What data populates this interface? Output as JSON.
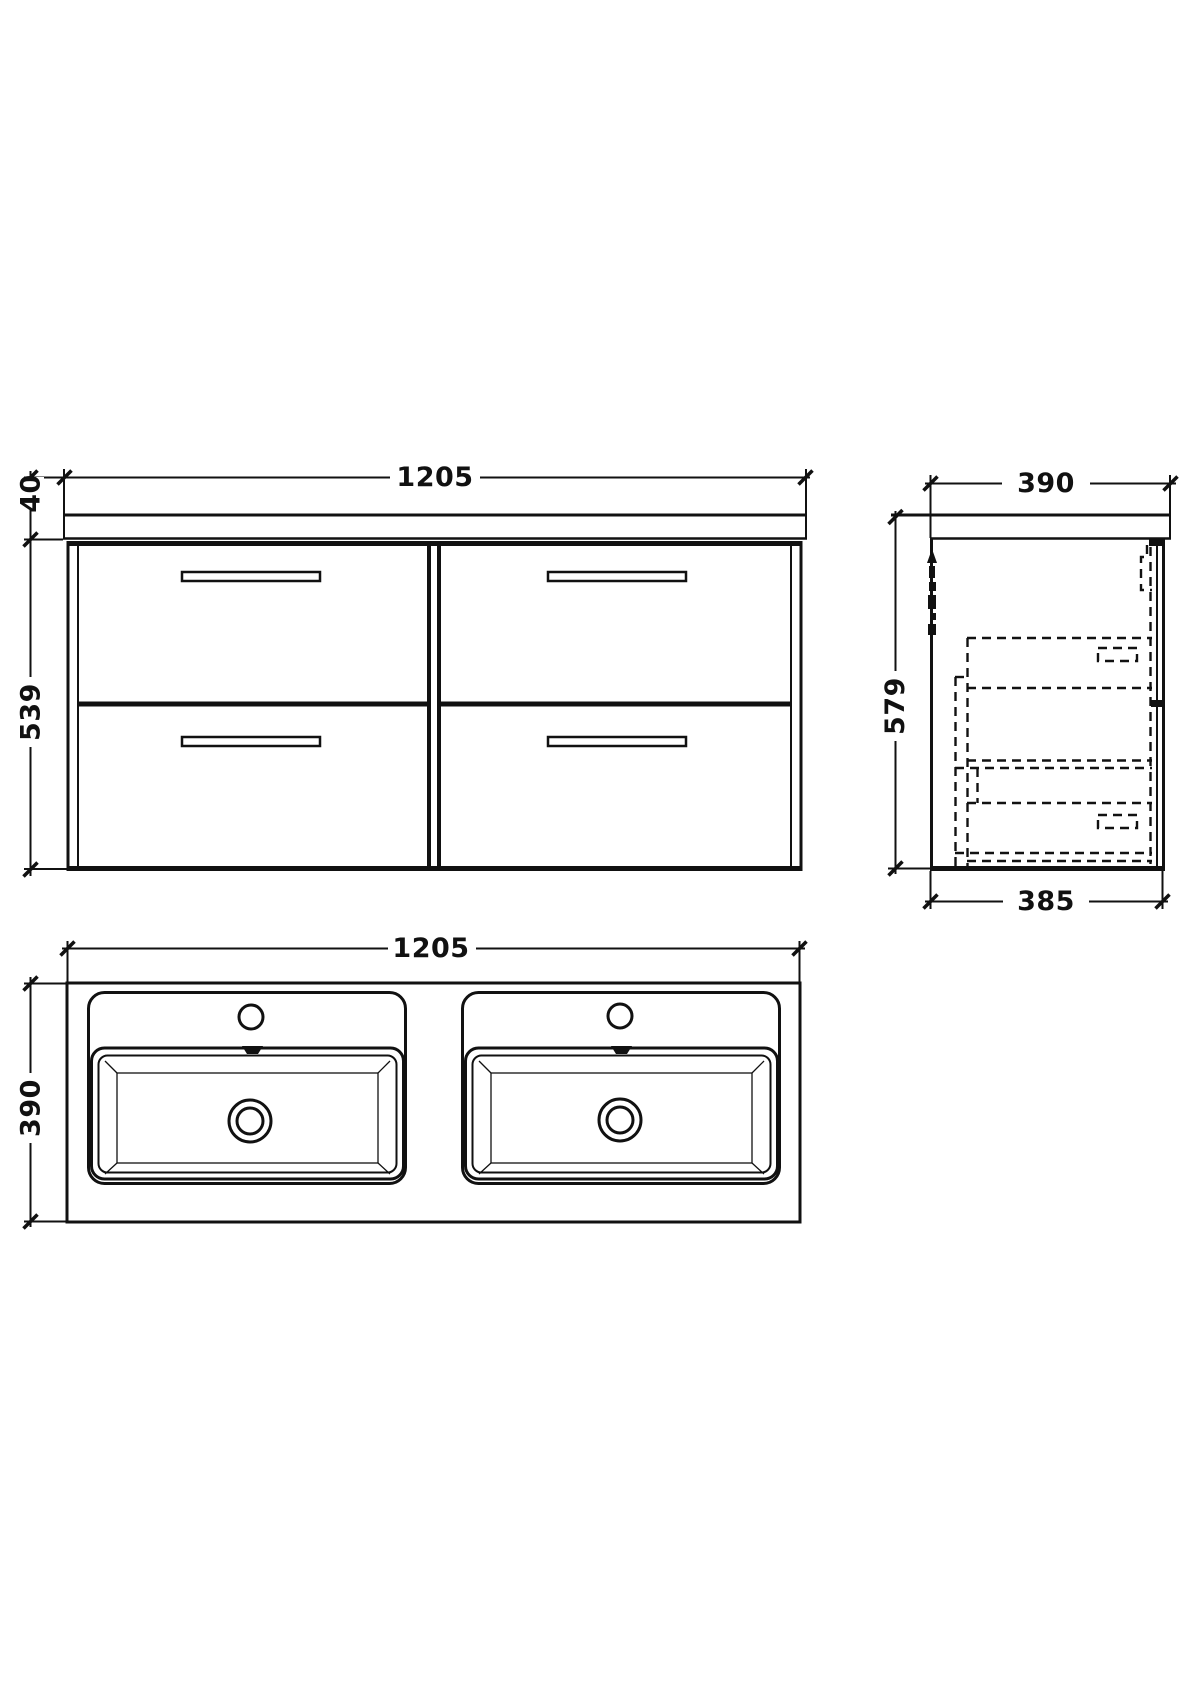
{
  "drawing": {
    "front_view": {
      "width": "1205",
      "counter_thickness": "40",
      "cabinet_height": "539"
    },
    "side_view": {
      "depth": "390",
      "total_height": "579",
      "cabinet_depth": "385"
    },
    "plan_view": {
      "width": "1205",
      "depth": "390"
    },
    "colors": {
      "line": "#111111",
      "background": "#ffffff"
    }
  }
}
